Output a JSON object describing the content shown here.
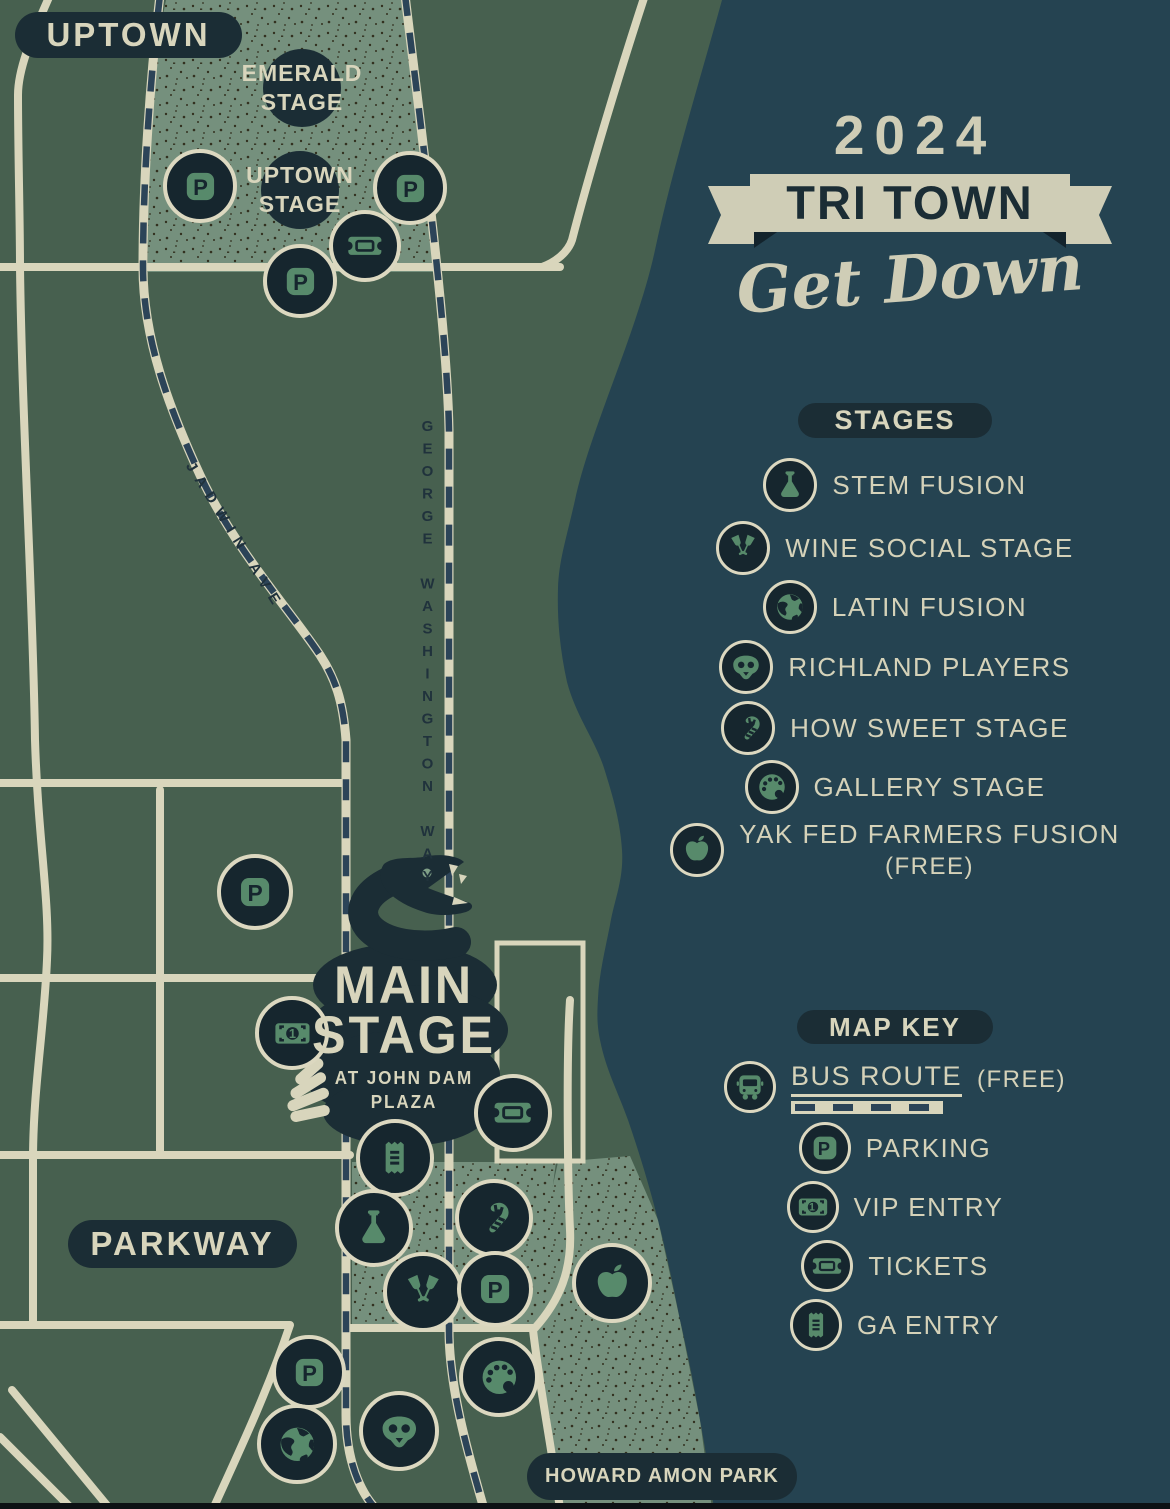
{
  "poster": {
    "title_year": "2024",
    "title_main": "TRI TOWN",
    "title_script": "Get Down"
  },
  "map": {
    "district_labels": {
      "uptown": "UPTOWN",
      "parkway": "PARKWAY",
      "howard_amon_park": "HOWARD AMON PARK"
    },
    "street_labels": {
      "jadwin": "JADWIN AVE",
      "george_washington": "GEORGE WASHINGTON WAY"
    },
    "stage_labels": {
      "emerald": {
        "l1": "EMERALD",
        "l2": "STAGE"
      },
      "uptown": {
        "l1": "UPTOWN",
        "l2": "STAGE"
      },
      "main": {
        "l1": "MAIN",
        "l2": "STAGE",
        "sub1": "AT JOHN DAM",
        "sub2": "PLAZA"
      }
    },
    "markers": [
      {
        "icon": "parking",
        "x": 200,
        "y": 186,
        "r": 33
      },
      {
        "icon": "parking",
        "x": 410,
        "y": 188,
        "r": 33
      },
      {
        "icon": "ticket",
        "x": 365,
        "y": 246,
        "r": 32
      },
      {
        "icon": "parking",
        "x": 300,
        "y": 281,
        "r": 33
      },
      {
        "icon": "parking",
        "x": 255,
        "y": 892,
        "r": 34
      },
      {
        "icon": "money",
        "x": 292,
        "y": 1033,
        "r": 33
      },
      {
        "icon": "ticket",
        "x": 513,
        "y": 1113,
        "r": 35
      },
      {
        "icon": "receipt",
        "x": 395,
        "y": 1158,
        "r": 35
      },
      {
        "icon": "candy-cane",
        "x": 494,
        "y": 1218,
        "r": 35
      },
      {
        "icon": "flask",
        "x": 374,
        "y": 1228,
        "r": 35
      },
      {
        "icon": "wine",
        "x": 423,
        "y": 1292,
        "r": 36
      },
      {
        "icon": "parking",
        "x": 495,
        "y": 1289,
        "r": 34
      },
      {
        "icon": "apple",
        "x": 612,
        "y": 1283,
        "r": 36
      },
      {
        "icon": "parking",
        "x": 309,
        "y": 1372,
        "r": 33
      },
      {
        "icon": "palette",
        "x": 499,
        "y": 1377,
        "r": 36
      },
      {
        "icon": "mask",
        "x": 399,
        "y": 1431,
        "r": 36
      },
      {
        "icon": "globe",
        "x": 297,
        "y": 1444,
        "r": 36
      }
    ]
  },
  "legend_stages": {
    "title": "STAGES",
    "items": [
      {
        "icon": "flask",
        "label": "STEM FUSION"
      },
      {
        "icon": "wine",
        "label": "WINE SOCIAL STAGE"
      },
      {
        "icon": "globe",
        "label": "LATIN FUSION"
      },
      {
        "icon": "mask",
        "label": "RICHLAND PLAYERS"
      },
      {
        "icon": "candy-cane",
        "label": "HOW SWEET STAGE"
      },
      {
        "icon": "palette",
        "label": "GALLERY STAGE"
      },
      {
        "icon": "apple",
        "label": "YAK FED FARMERS FUSION",
        "note": "(FREE)"
      }
    ]
  },
  "map_key": {
    "title": "MAP KEY",
    "items": [
      {
        "icon": "bus",
        "label": "BUS ROUTE",
        "note": "(FREE)"
      },
      {
        "icon": "parking",
        "label": "PARKING"
      },
      {
        "icon": "money",
        "label": "VIP ENTRY"
      },
      {
        "icon": "ticket",
        "label": "TICKETS"
      },
      {
        "icon": "receipt",
        "label": "GA ENTRY"
      }
    ]
  },
  "colors": {
    "land": "#47604f",
    "district_speckle": "#75907d",
    "river": "#254351",
    "ink": "#1b2d35",
    "cream": "#d8d5bc",
    "icon_green": "#578a6b",
    "bus_dash": "#2c4458"
  }
}
